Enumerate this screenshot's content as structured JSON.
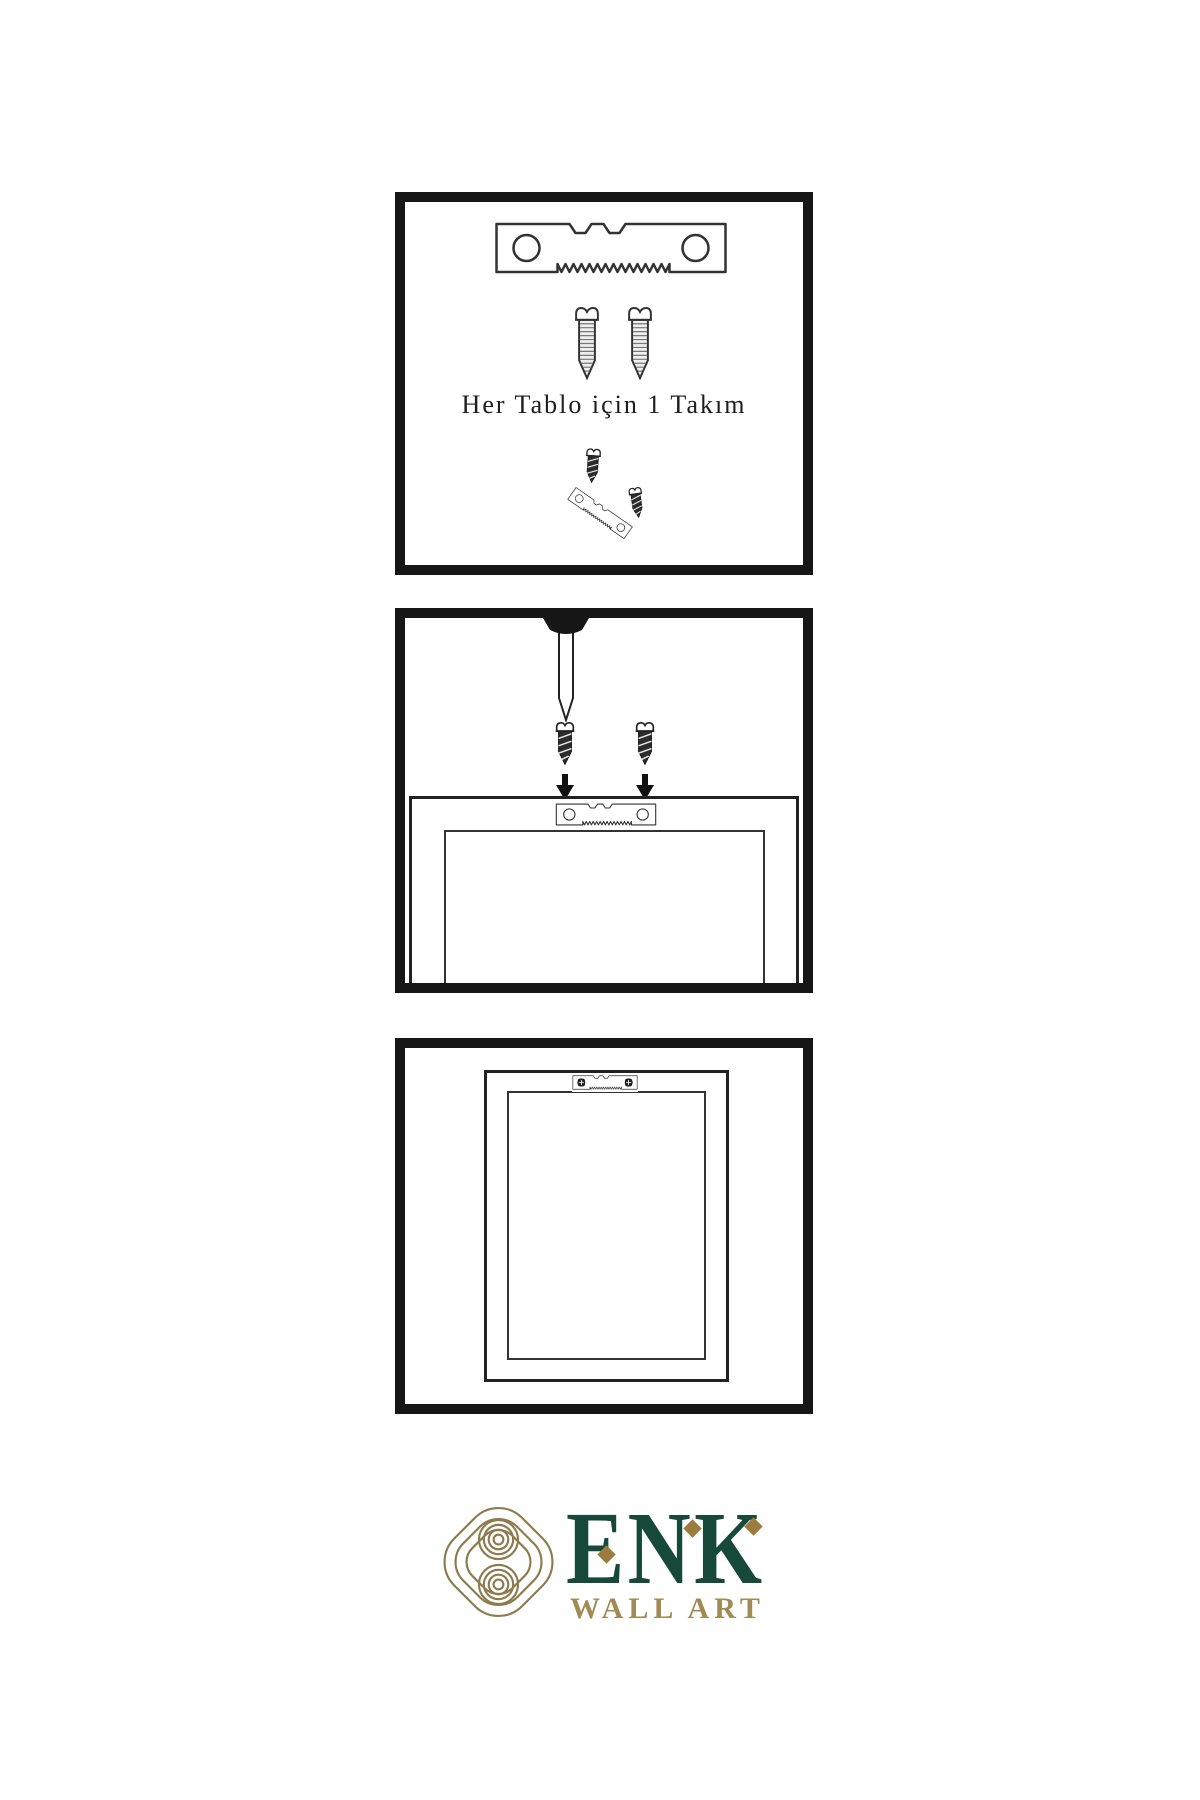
{
  "canvas": {
    "background": "#ffffff",
    "ink": "#161616",
    "line_color": "#333333"
  },
  "steps": [
    {
      "id": "step-1-hardware-kit",
      "caption": "Her Tablo için 1 Takım",
      "icons": [
        "sawtooth-hanger-icon",
        "screw-icon",
        "screw-icon",
        "screw-hanger-assembly-icon"
      ]
    },
    {
      "id": "step-2-install",
      "icons": [
        "nail-icon",
        "screw-dark-icon",
        "screw-dark-icon",
        "arrow-down-icon",
        "arrow-down-icon",
        "frame-back-with-hanger"
      ]
    },
    {
      "id": "step-3-result",
      "icons": [
        "frame-back-with-mounted-hanger"
      ]
    }
  ],
  "logo": {
    "brand": "ENK",
    "subtitle": "WALL ART",
    "brand_color": "#17493b",
    "gold_color": "#a18b55",
    "knot_color": "#8d7b4d",
    "icons": [
      "knot-logo-icon",
      "diamond-accent-icon",
      "diamond-accent-icon",
      "diamond-accent-icon"
    ]
  }
}
